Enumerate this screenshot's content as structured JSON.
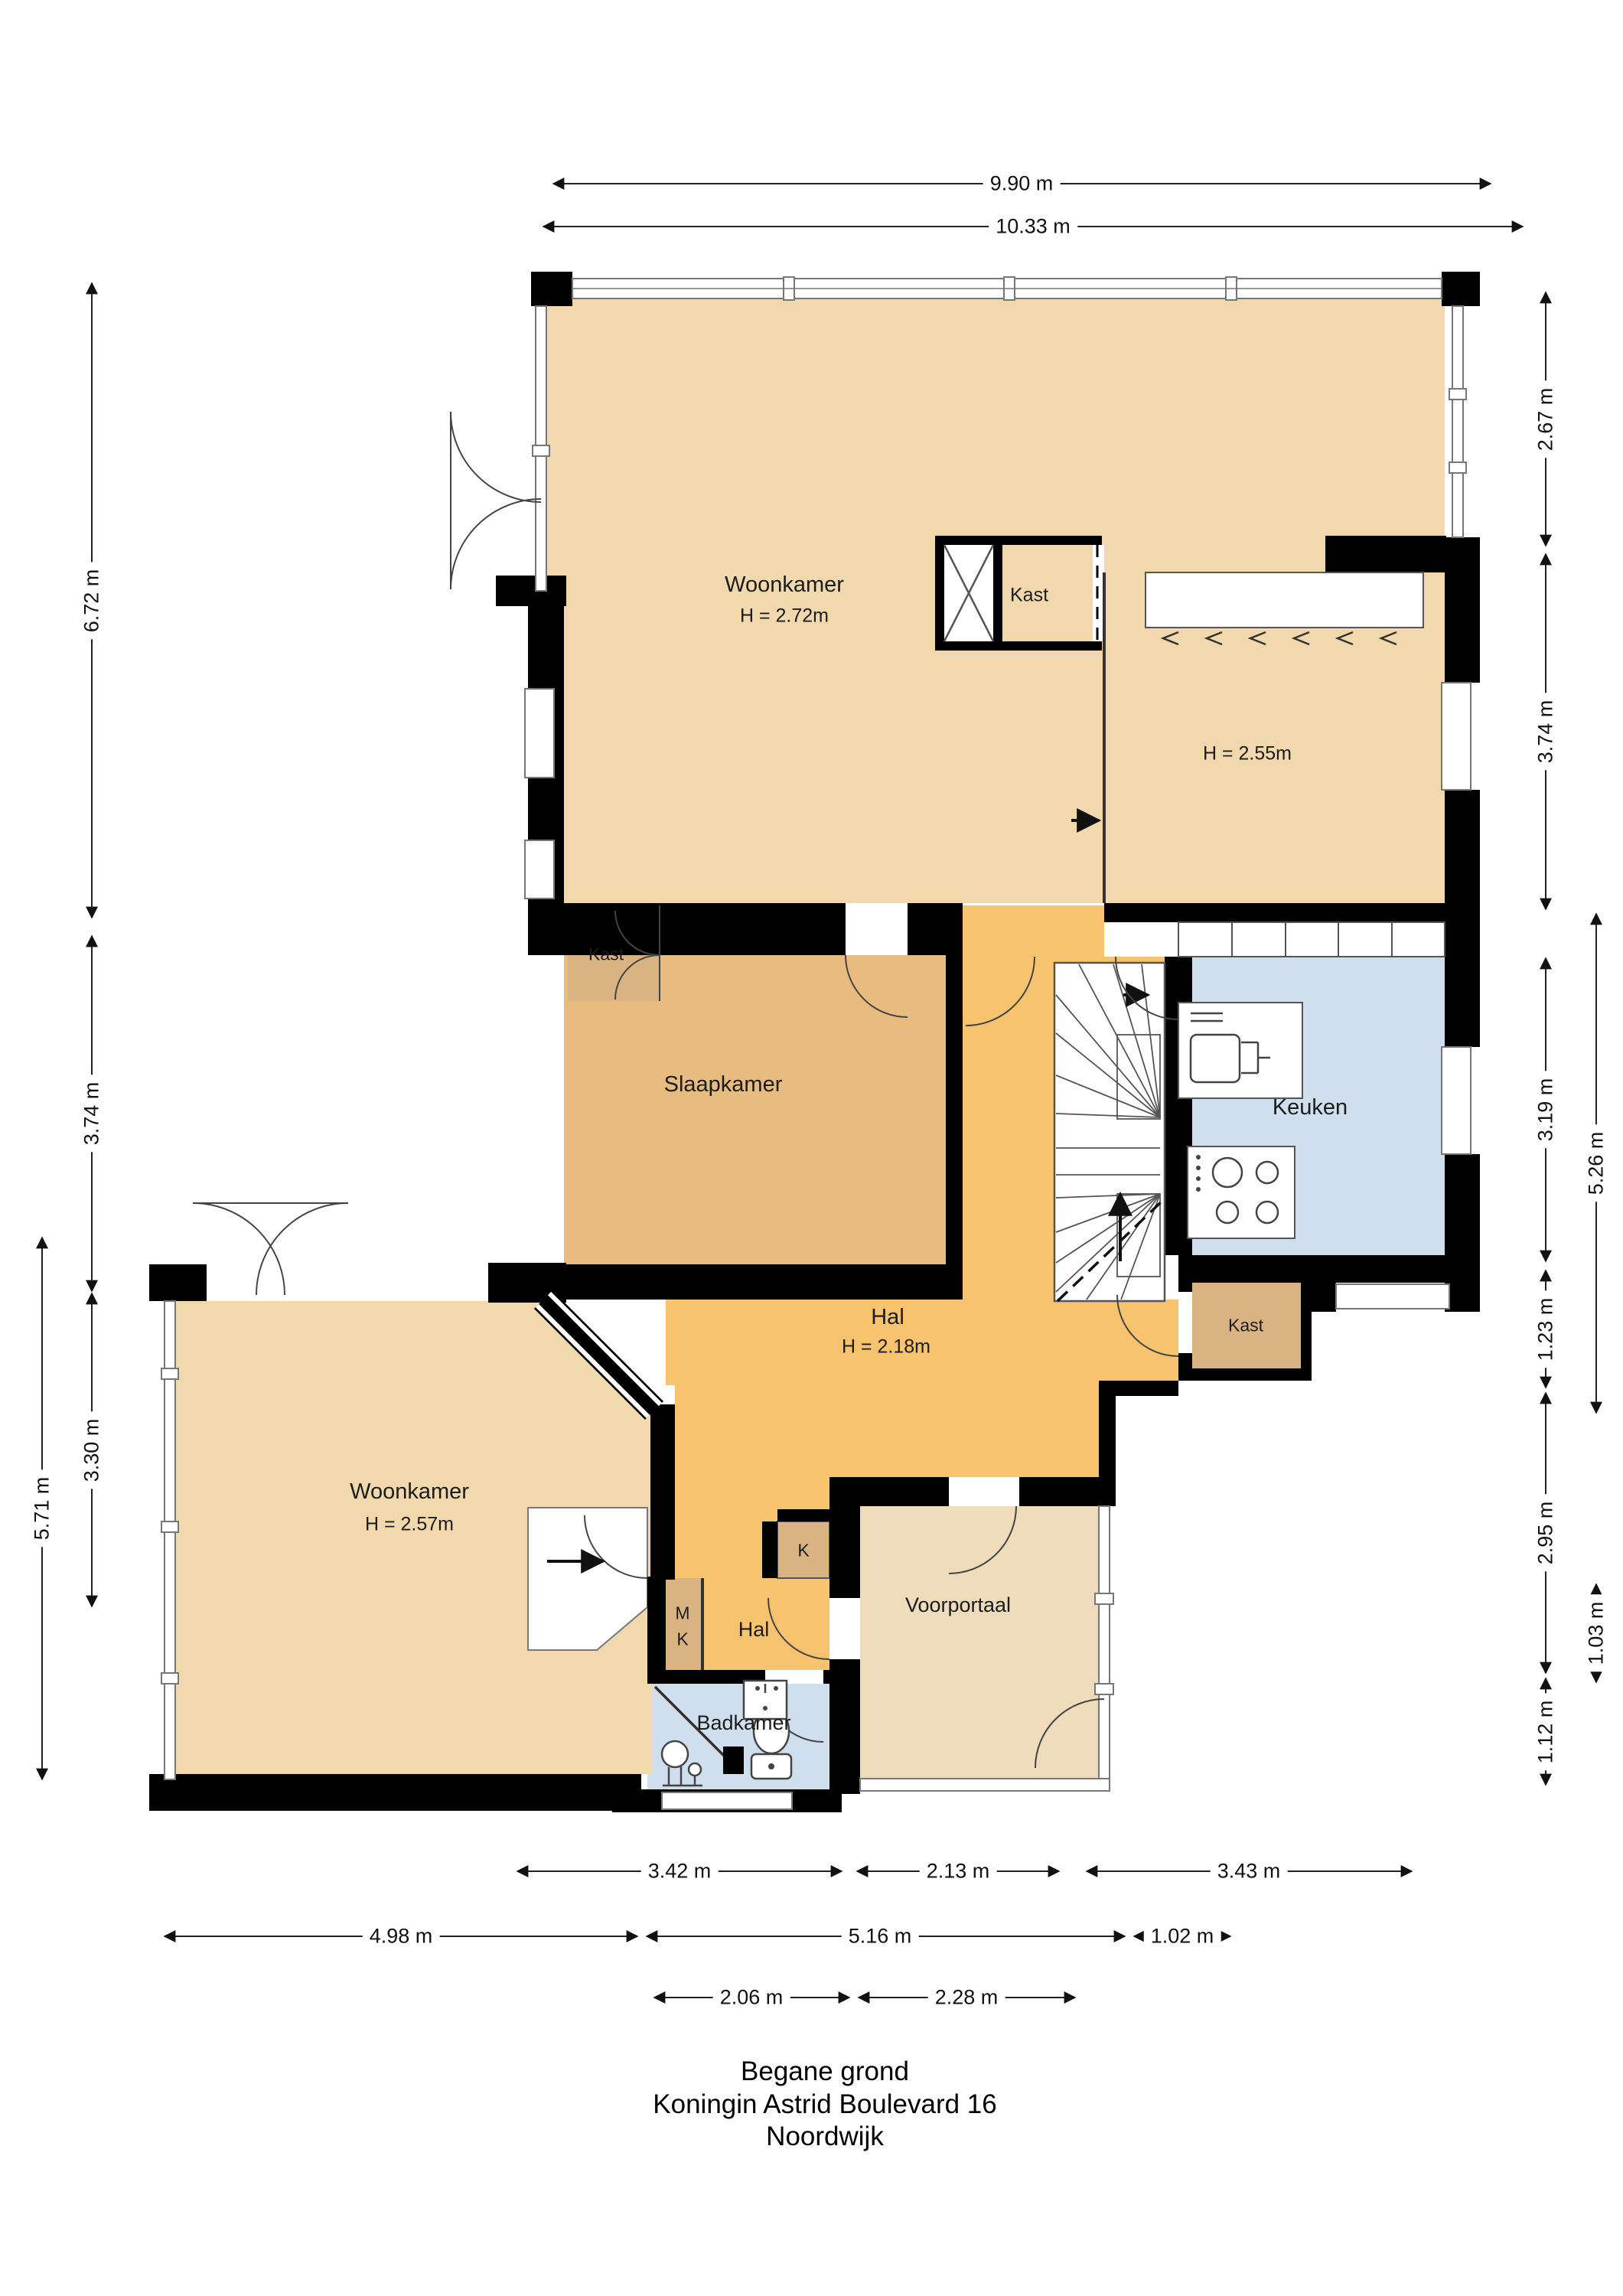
{
  "title": {
    "line1": "Begane grond",
    "line2": "Koningin Astrid Boulevard 16",
    "line3": "Noordwijk"
  },
  "rooms": {
    "woonkamer_top": {
      "name": "Woonkamer",
      "height": "H = 2.72m"
    },
    "eethoek": {
      "height": "H = 2.55m"
    },
    "kast_top": {
      "name": "Kast"
    },
    "slaapkamer": {
      "name": "Slaapkamer"
    },
    "kast_slaapkamer": {
      "name": "Kast"
    },
    "keuken": {
      "name": "Keuken"
    },
    "hal": {
      "name": "Hal",
      "height": "H = 2.18m"
    },
    "kast_hal": {
      "name": "Kast"
    },
    "woonkamer_beneden": {
      "name": "Woonkamer",
      "height": "H = 2.57m"
    },
    "meterkast": {
      "line1": "M",
      "line2": "K"
    },
    "kast_k": {
      "name": "K"
    },
    "hal_klein": {
      "name": "Hal"
    },
    "voorportaal": {
      "name": "Voorportaal"
    },
    "badkamer": {
      "name": "Badkamer"
    }
  },
  "dims": {
    "top": [
      "9.90 m",
      "10.33 m"
    ],
    "left": [
      "6.72 m",
      "3.74 m",
      "3.30 m",
      "5.71 m"
    ],
    "right": [
      "2.67 m",
      "3.74 m",
      "3.19 m",
      "1.23 m",
      "2.95 m",
      "1.12 m"
    ],
    "right_outer": [
      "5.26 m",
      "1.03 m"
    ],
    "bottom": [
      "3.42 m",
      "2.13 m",
      "3.43 m",
      "4.98 m",
      "5.16 m",
      "1.02 m",
      "2.06 m",
      "2.28 m"
    ]
  },
  "colors": {
    "floor_tan": "#f2d9ad",
    "floor_slaapkamer": "#e7bc7e",
    "floor_kast": "#d9b482",
    "floor_hal": "#f8c36e",
    "floor_voorportaal": "#eedcba",
    "floor_blue": "#cfdfed",
    "wall": "#000000"
  }
}
